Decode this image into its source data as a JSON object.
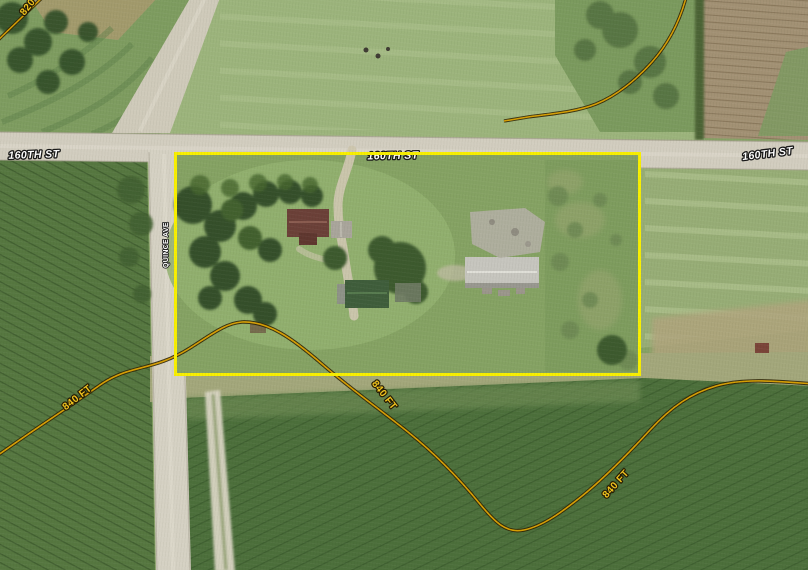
{
  "map": {
    "kind": "aerial-parcel-map",
    "roads": {
      "h_left": "160TH ST",
      "h_center": "160TH ST",
      "h_right": "160TH ST",
      "avenue": "QUINCE AVE"
    },
    "contours": {
      "top_left": "820",
      "bottom_left": "840 FT",
      "bottom_center": "840 FT",
      "bottom_right": "840 FT"
    },
    "colors": {
      "boundary": "#f8ef00",
      "contour_core": "#d79f04",
      "contour_casing": "#2f2506",
      "road_surface": "#d2cdbf",
      "road_label_fill": "#ffffff",
      "contour_label_fill": "#f2c41d"
    }
  }
}
